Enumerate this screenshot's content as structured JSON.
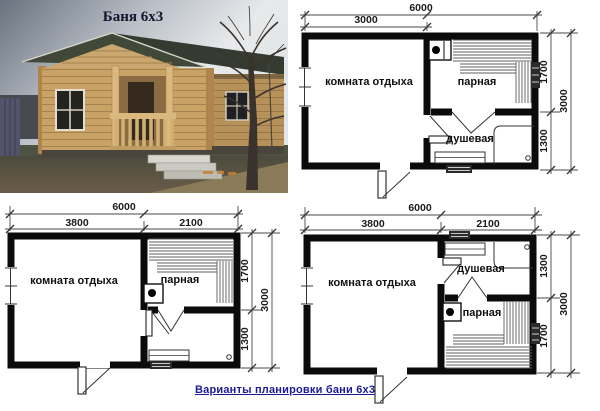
{
  "photo": {
    "title": "Баня 6х3"
  },
  "footer": {
    "title": "Варианты планировки бани 6х3"
  },
  "colors": {
    "caption_blue": "#1b1b96",
    "wall_black": "#0b0b0b",
    "roof_green": "#3a4334",
    "log_wood": "#c9a266"
  },
  "plans": [
    {
      "position": "top-right",
      "rooms": {
        "rest": "комната отдыха",
        "steam": "парная",
        "shower": "душевая"
      },
      "dims": {
        "width_total": "6000",
        "width_left": "3000",
        "height_total": "3000",
        "height_top": "1700",
        "height_bottom": "1300"
      }
    },
    {
      "position": "bottom-left",
      "rooms": {
        "rest": "комната отдыха",
        "steam": "парная"
      },
      "dims": {
        "width_total": "6000",
        "width_left": "3800",
        "width_right": "2100",
        "height_total": "3000",
        "height_top": "1700",
        "height_bottom": "1300"
      }
    },
    {
      "position": "bottom-right",
      "rooms": {
        "rest": "комната отдыха",
        "shower": "душевая",
        "steam": "парная"
      },
      "dims": {
        "width_total": "6000",
        "width_left": "3800",
        "width_right": "2100",
        "height_total": "3000",
        "height_top": "1300",
        "height_bottom": "1700"
      }
    }
  ]
}
